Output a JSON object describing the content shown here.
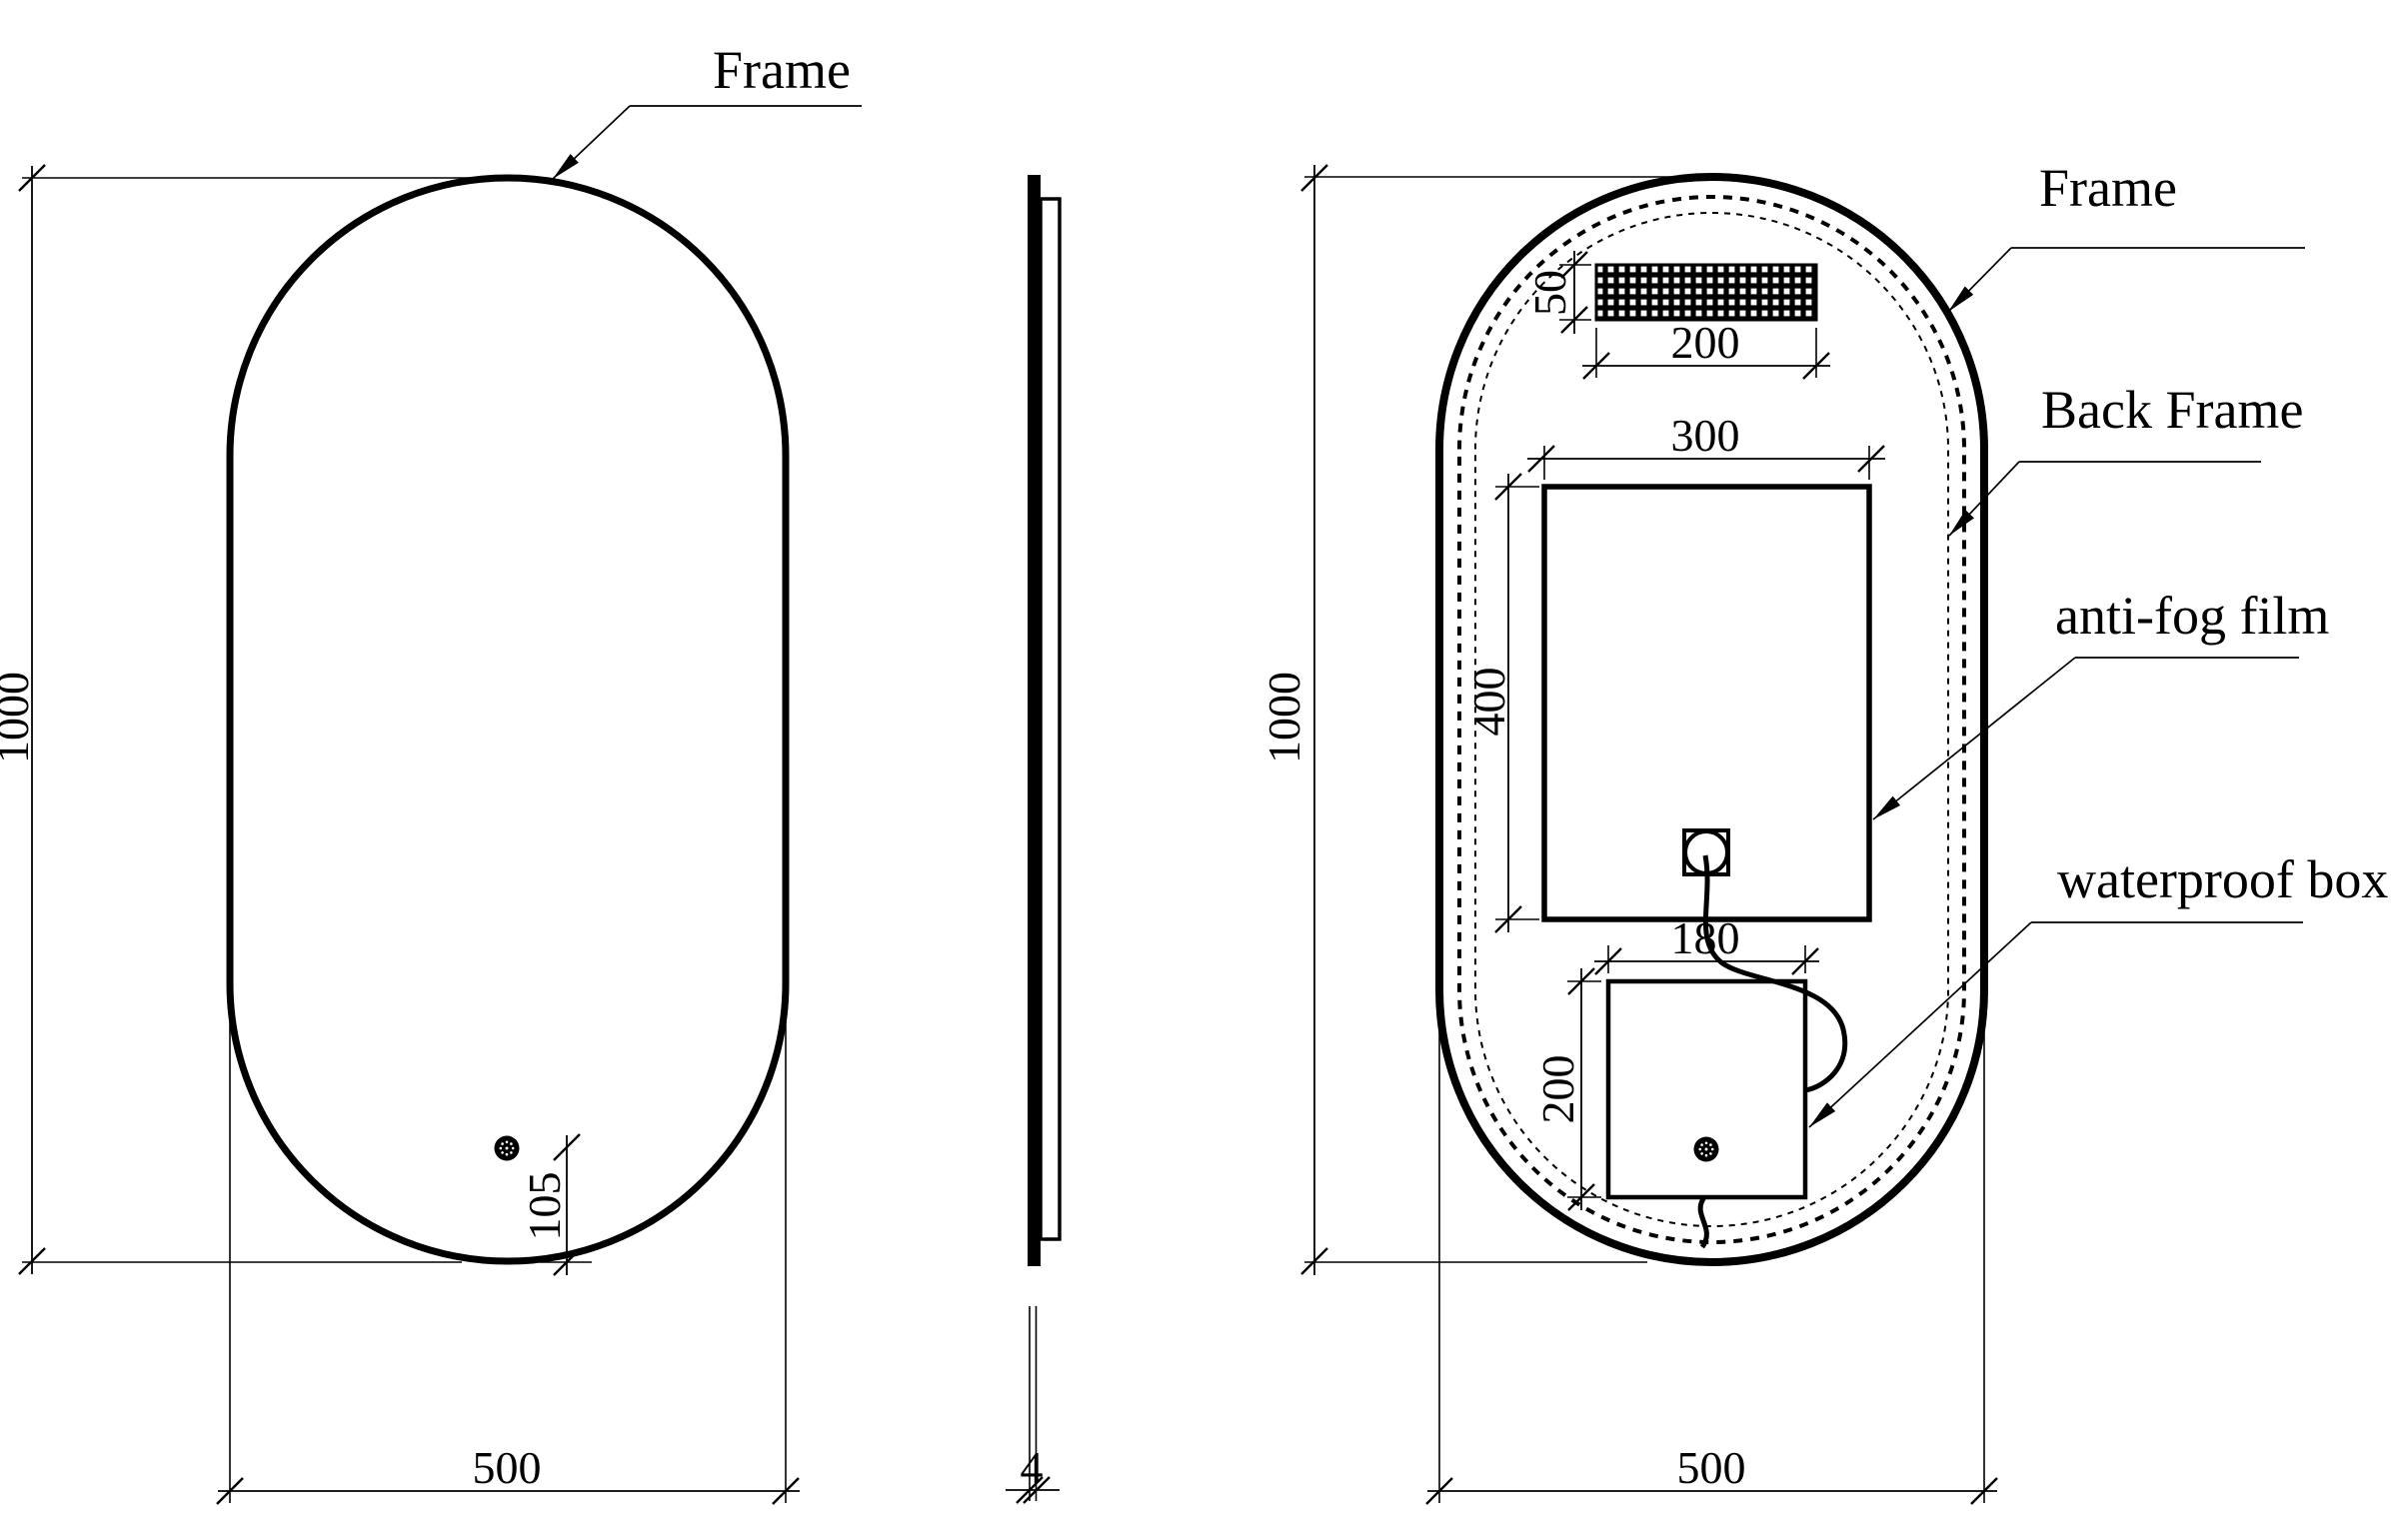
{
  "drawing": {
    "background_color": "#ffffff",
    "line_color": "#000000",
    "front_view": {
      "frame_label": "Frame",
      "height_dim": "1000",
      "width_dim": "500",
      "sensor_offset_dim": "105"
    },
    "side_view": {
      "thickness_dim": "4"
    },
    "back_view": {
      "frame_label": "Frame",
      "back_frame_label": "Back Frame",
      "anti_fog_film_label": "anti-fog film",
      "waterproof_box_label": "waterproof box",
      "height_dim": "1000",
      "width_dim": "500",
      "led_strip_height_dim": "50",
      "led_strip_width_dim": "200",
      "film_width_dim": "300",
      "film_height_dim": "400",
      "box_width_dim": "180",
      "box_height_dim": "200"
    }
  }
}
